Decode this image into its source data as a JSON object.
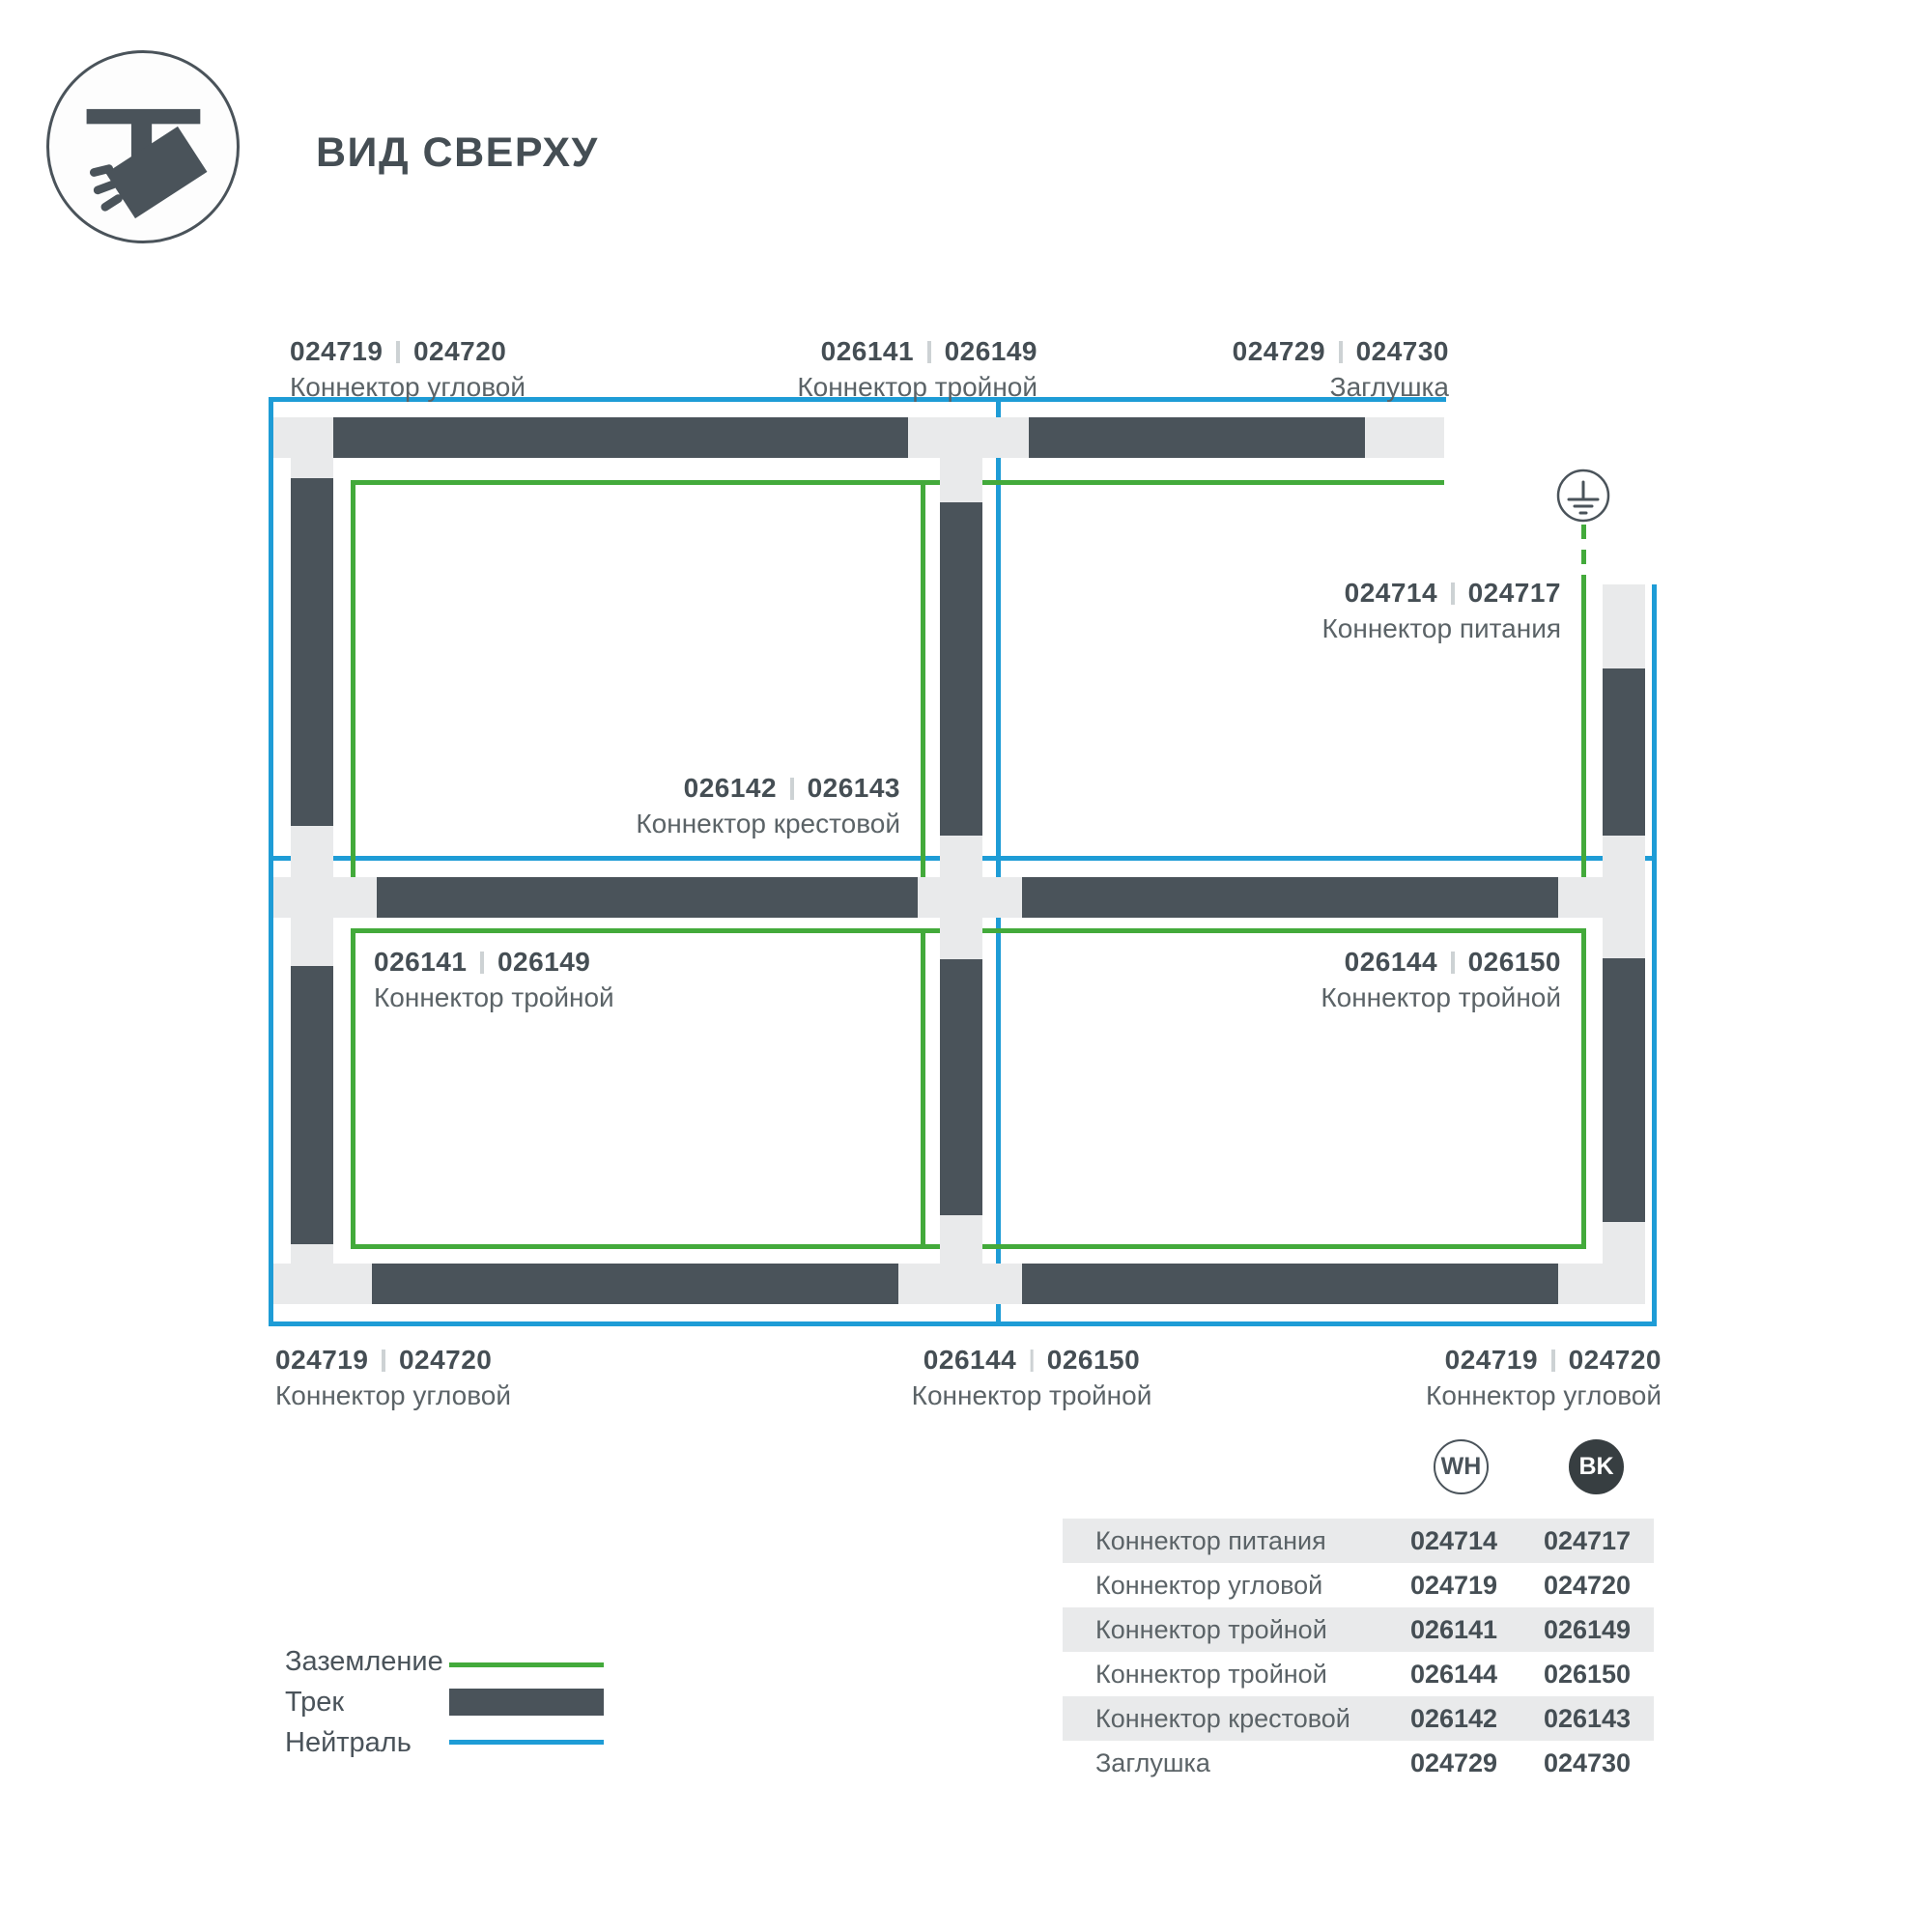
{
  "header": {
    "title": "ВИД СВЕРХУ",
    "icon": "track-spotlight-icon"
  },
  "colors": {
    "ground_green": "#43AA3B",
    "neutral_blue": "#1E9CD6",
    "track_dark": "#4A535A",
    "track_light": "#E9EAEB",
    "badge_black": "#373E41",
    "text_dark": "#454E54",
    "text_gray": "#5B6367"
  },
  "diagram": {
    "ground_symbol": "earth-ground-icon",
    "labels": [
      {
        "wh": "024719",
        "bk": "024720",
        "name": "Коннектор угловой"
      },
      {
        "wh": "026141",
        "bk": "026149",
        "name": "Коннектор тройной"
      },
      {
        "wh": "024729",
        "bk": "024730",
        "name": "Заглушка"
      },
      {
        "wh": "024714",
        "bk": "024717",
        "name": "Коннектор питания"
      },
      {
        "wh": "026142",
        "bk": "026143",
        "name": "Коннектор крестовой"
      },
      {
        "wh": "026141",
        "bk": "026149",
        "name": "Коннектор тройной"
      },
      {
        "wh": "026144",
        "bk": "026150",
        "name": "Коннектор тройной"
      },
      {
        "wh": "024719",
        "bk": "024720",
        "name": "Коннектор угловой"
      },
      {
        "wh": "026144",
        "bk": "026150",
        "name": "Коннектор тройной"
      },
      {
        "wh": "024719",
        "bk": "024720",
        "name": "Коннектор угловой"
      }
    ]
  },
  "legend": {
    "items": [
      {
        "label": "Заземление",
        "swatch": "green-line"
      },
      {
        "label": "Трек",
        "swatch": "dark-track-bar"
      },
      {
        "label": "Нейтраль",
        "swatch": "blue-line"
      }
    ]
  },
  "table": {
    "columns": [
      {
        "badge": "WH"
      },
      {
        "badge": "BK"
      }
    ],
    "rows": [
      {
        "name": "Коннектор питания",
        "wh": "024714",
        "bk": "024717"
      },
      {
        "name": "Коннектор угловой",
        "wh": "024719",
        "bk": "024720"
      },
      {
        "name": "Коннектор тройной",
        "wh": "026141",
        "bk": "026149"
      },
      {
        "name": "Коннектор тройной",
        "wh": "026144",
        "bk": "026150"
      },
      {
        "name": "Коннектор крестовой",
        "wh": "026142",
        "bk": "026143"
      },
      {
        "name": "Заглушка",
        "wh": "024729",
        "bk": "024730"
      }
    ]
  }
}
